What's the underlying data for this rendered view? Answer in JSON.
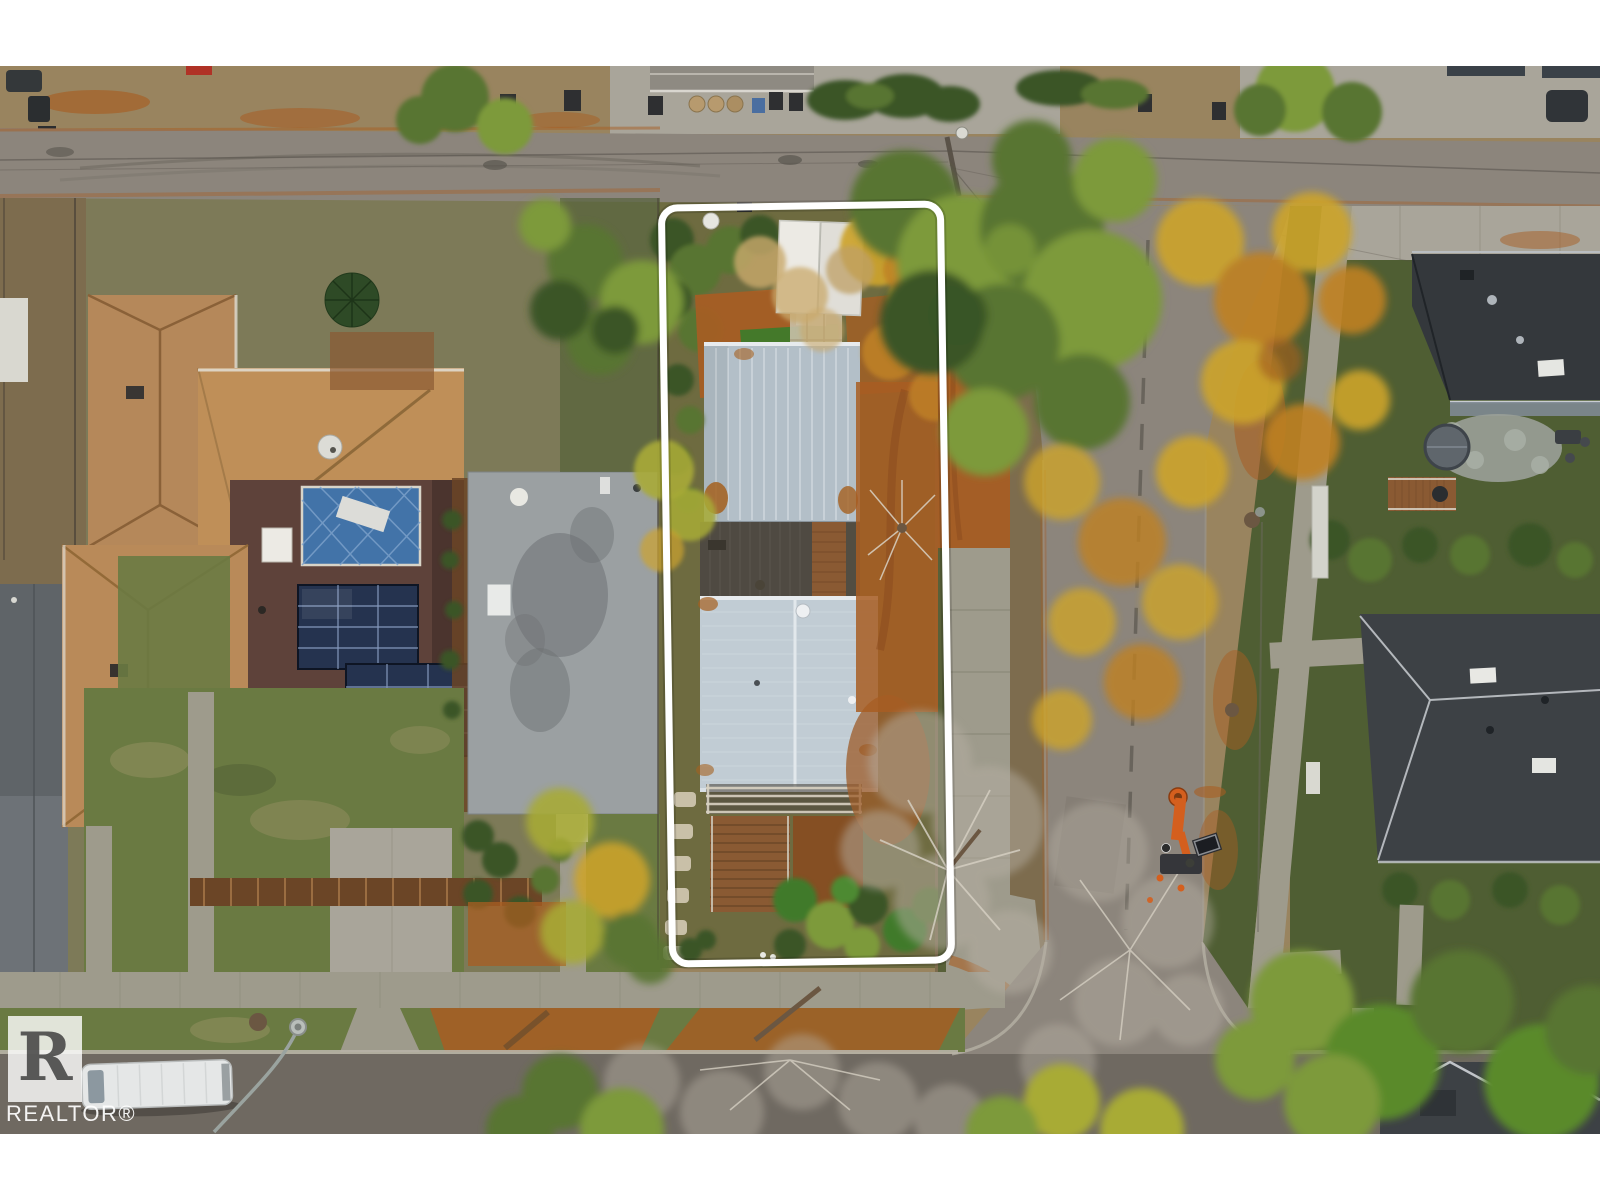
{
  "watermark": {
    "logo_letter": "R",
    "brand_text": "REALTOR®"
  },
  "photo": {
    "letterbox_color": "#ffffff",
    "property_outline_color": "#ffffff"
  },
  "colors": {
    "letterbox": "#ffffff",
    "outline-white": "#ffffff",
    "asphalt": "#8c857c",
    "street-bottom": "#6f6961",
    "concrete": "#a9a59a",
    "sidewalk": "#9e9b8c",
    "concrete-light": "#c6c2b4",
    "dirt": "#99845f",
    "dirt-dark": "#7d6c4e",
    "mulch": "#a85d22",
    "mulch-dark": "#8a4a1e",
    "lawn": "#6a7a42",
    "lawn-dark": "#4f5e33",
    "lawn-dry": "#8f8d5e",
    "grass-bright": "#3f7a2a",
    "hedge": "#3a5426",
    "tree-green": "#587530",
    "tree-green-light": "#7d9a3a",
    "tree-yellowgreen": "#a8ab36",
    "tree-gold": "#cda42c",
    "tree-amber": "#c08124",
    "tree-rust": "#a5601f",
    "bare": "#b5aea2",
    "trunk": "#6b5742",
    "tan-roof": "#b5885a",
    "tan-roof2": "#bf8f58",
    "maroon": "#5e423a",
    "maroon-dark": "#4b342e",
    "courtyard-blue": "#4273a8",
    "solar": "#25334f",
    "flat-gray": "#9ba0a2",
    "flat-gray-dark": "#697075",
    "charcoal": "#34383c",
    "charcoal2": "#3d4145",
    "blue-wall": "#7e8a92",
    "metal": "#c1ccd4",
    "metal2": "#b3bfc8",
    "white-struct": "#eceae4",
    "deck": "#4f4a42",
    "wood": "#8a5a33",
    "wood-dark": "#6b4526",
    "stone": "#c9c0a8",
    "van": "#e5e7e7",
    "machine-orange": "#d45f1e",
    "wire": "#55514a",
    "garden-base": "#6e6b40",
    "ground-base": "#7d7a58",
    "wm-bg": "rgba(255,255,255,0.80)",
    "wm-letter": "rgba(42,42,42,0.75)",
    "wm-text": "rgba(255,255,255,0.92)"
  }
}
